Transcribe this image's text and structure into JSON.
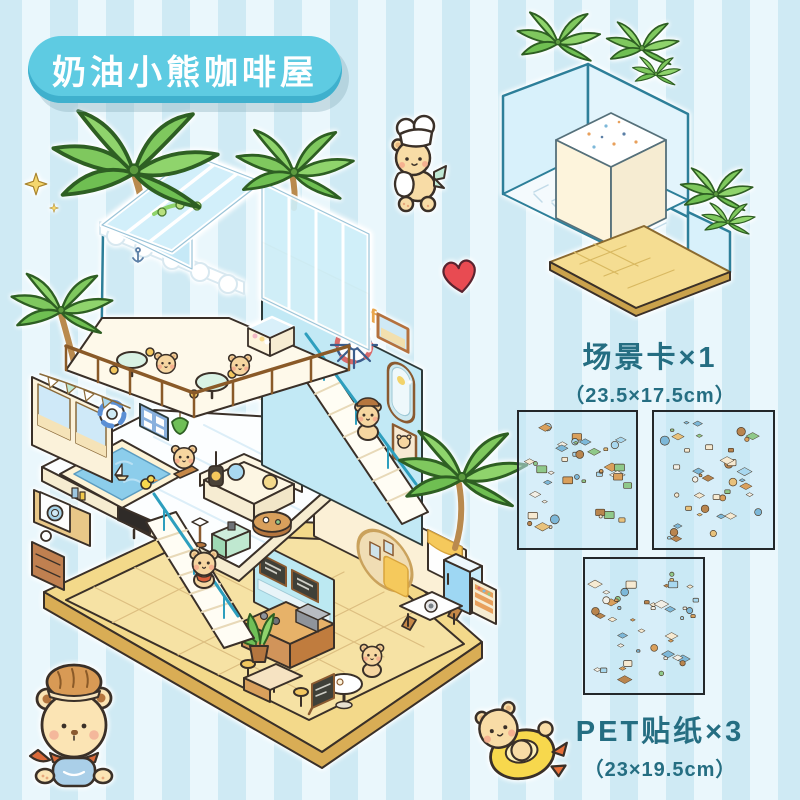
{
  "title_badge": {
    "label": "奶油小熊咖啡屋"
  },
  "main_illustration": {
    "coffee_sign": "coffee"
  },
  "scene_card": {
    "label": "场景卡×1",
    "dimensions": "（23.5×17.5cm）",
    "count": 1
  },
  "sticker_sheets": {
    "label": "PET贴纸×3",
    "dimensions": "（23×19.5cm）",
    "count": 3
  },
  "colors": {
    "stripe_a": "#cfeaf4",
    "stripe_b": "#eaf7fc",
    "badge_blue": "#5ecbe2",
    "badge_edge": "#3fb0cd",
    "caption_teal": "#256e82",
    "heart_red": "#e84b52",
    "palm_green": "#7fc85e",
    "pool_blue": "#8ccdeb",
    "glass_blue": "#cdeef9",
    "wood_tan": "#e7b269",
    "floor_yellow": "#f6e2a4",
    "platform_yellow": "#f3d98a",
    "exterior_wall_blue": "#c2e9f5",
    "cream": "#fdf3d9"
  }
}
